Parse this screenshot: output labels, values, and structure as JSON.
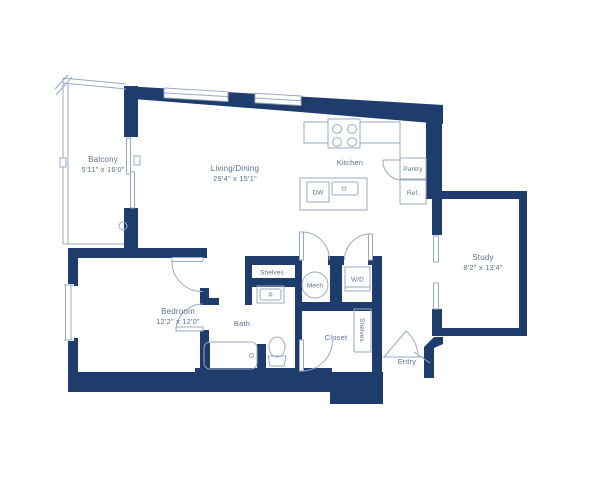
{
  "colors": {
    "wall": "#1e3c6c",
    "line": "#9aa9c2",
    "text": "#5f6f90"
  },
  "labels": {
    "balcony": {
      "name": "Balcony",
      "dims": "5'11\" x 16'0\""
    },
    "living_dining": {
      "name": "Living/Dining",
      "dims": "29'4\" x 15'1\""
    },
    "kitchen": {
      "name": "Kitchen"
    },
    "pantry": {
      "name": "Pantry"
    },
    "ref": {
      "name": "Ref."
    },
    "dw": {
      "name": "DW"
    },
    "study": {
      "name": "Study",
      "dims": "8'2\" x 13'4\""
    },
    "shelves_bath": {
      "name": "Shelves"
    },
    "mech": {
      "name": "Mech"
    },
    "wd": {
      "name": "W/D"
    },
    "bath": {
      "name": "Bath"
    },
    "bedroom": {
      "name": "Bedroom",
      "dims": "12'2\" x 12'0\""
    },
    "closet": {
      "name": "Closet"
    },
    "shelves_closet": {
      "name": "Shelves"
    },
    "entry": {
      "name": "Entry"
    }
  }
}
